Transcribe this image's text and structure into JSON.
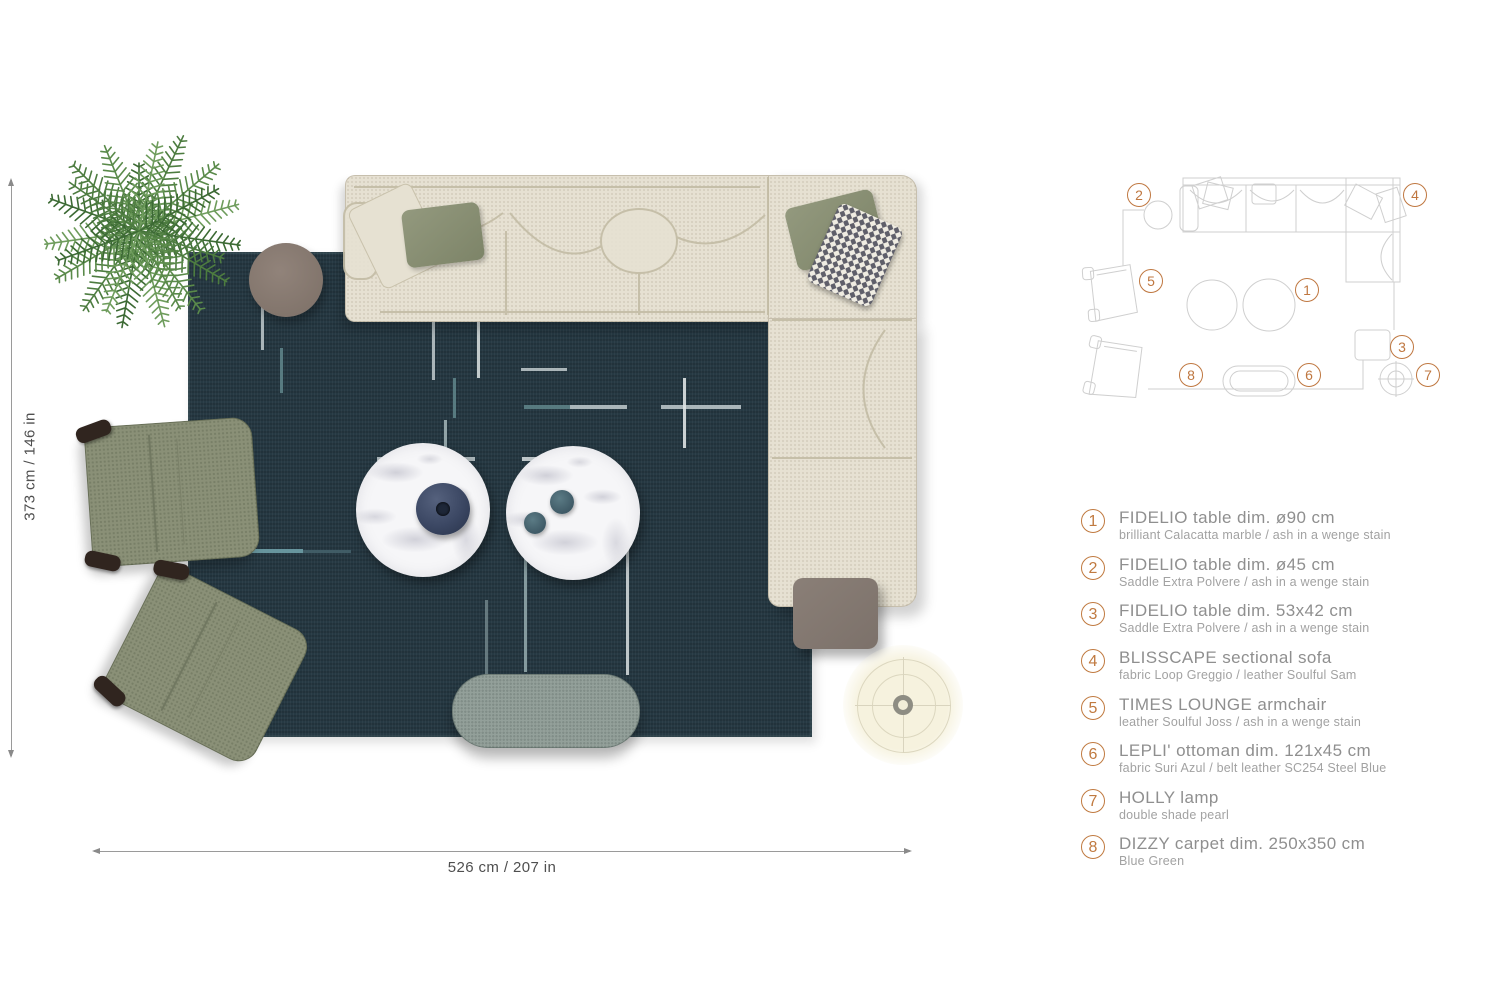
{
  "dimensions": {
    "vertical": "373 cm / 146 in",
    "horizontal": "526 cm / 207 in"
  },
  "legend": [
    {
      "num": "1",
      "title": "FIDELIO table dim. ø90 cm",
      "subtitle": "brilliant Calacatta marble / ash in a wenge stain"
    },
    {
      "num": "2",
      "title": "FIDELIO table dim. ø45 cm",
      "subtitle": "Saddle Extra Polvere / ash in a wenge stain"
    },
    {
      "num": "3",
      "title": "FIDELIO table dim. 53x42 cm",
      "subtitle": "Saddle Extra Polvere / ash in a wenge stain"
    },
    {
      "num": "4",
      "title": "BLISSCAPE sectional sofa",
      "subtitle": "fabric Loop Greggio / leather Soulful Sam"
    },
    {
      "num": "5",
      "title": "TIMES LOUNGE armchair",
      "subtitle": "leather Soulful Joss / ash in a wenge stain"
    },
    {
      "num": "6",
      "title": "LEPLI' ottoman dim. 121x45 cm",
      "subtitle": "fabric Suri Azul / belt leather SC254 Steel Blue"
    },
    {
      "num": "7",
      "title": "HOLLY lamp",
      "subtitle": "double shade pearl"
    },
    {
      "num": "8",
      "title": "DIZZY carpet dim. 250x350 cm",
      "subtitle": "Blue Green"
    }
  ],
  "schematic_markers": [
    {
      "label": "1",
      "x": 227,
      "y": 122
    },
    {
      "label": "2",
      "x": 59,
      "y": 27
    },
    {
      "label": "3",
      "x": 322,
      "y": 179
    },
    {
      "label": "4",
      "x": 335,
      "y": 27
    },
    {
      "label": "5",
      "x": 71,
      "y": 113
    },
    {
      "label": "6",
      "x": 229,
      "y": 207
    },
    {
      "label": "7",
      "x": 348,
      "y": 207
    },
    {
      "label": "8",
      "x": 111,
      "y": 207
    }
  ],
  "colors": {
    "accent_orange": "#bf7740",
    "carpet_blue_green": "#263943",
    "sofa_cream": "#e6e1d2",
    "armchair_olive": "#8a9077",
    "ottoman_gray": "#93a09a",
    "wood_taupe": "#8b7d73",
    "legend_text": "#8f8f8f"
  }
}
